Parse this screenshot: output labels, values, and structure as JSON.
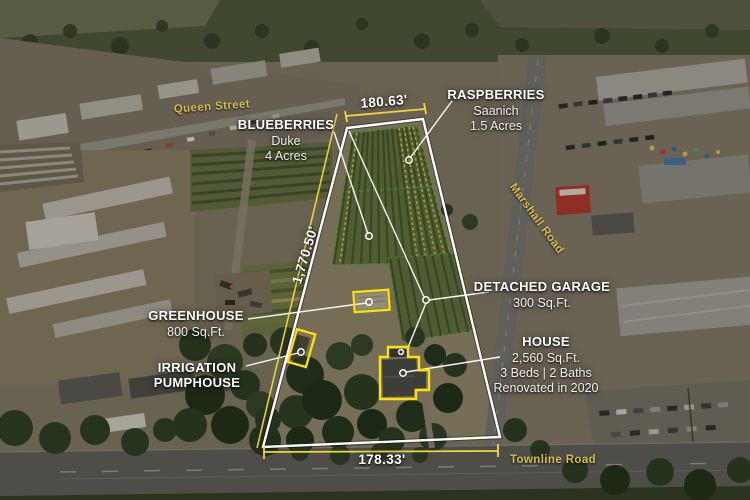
{
  "streets": {
    "queen_street": "Queen Street",
    "marshall_road": "Marshall Road",
    "townline_road": "Townline Road"
  },
  "measurements": {
    "top_frontage": "180.63'",
    "left_depth": "1,770.50'",
    "bottom_frontage": "178.33'"
  },
  "callouts": {
    "raspberries": {
      "title": "RASPBERRIES",
      "variety": "Saanich",
      "size": "1.5 Acres"
    },
    "blueberries": {
      "title": "BLUEBERRIES",
      "variety": "Duke",
      "size": "4 Acres"
    },
    "detached_garage": {
      "title": "DETACHED GARAGE",
      "size": "300 Sq.Ft."
    },
    "greenhouse": {
      "title": "GREENHOUSE",
      "size": "800 Sq.Ft."
    },
    "house": {
      "title": "HOUSE",
      "size": "2,560 Sq.Ft.",
      "beds_baths": "3 Beds | 2 Baths",
      "renovated": "Renovated in 2020"
    },
    "irrigation_pumphouse": {
      "title_line1": "IRRIGATION",
      "title_line2": "PUMPHOUSE"
    }
  },
  "colors": {
    "annotation_yellow": "#ffe10a",
    "lot_line_yellow": "#f2d63e",
    "road_label_yellow": "#d6bc4e",
    "boundary_white": "#ffffff"
  }
}
